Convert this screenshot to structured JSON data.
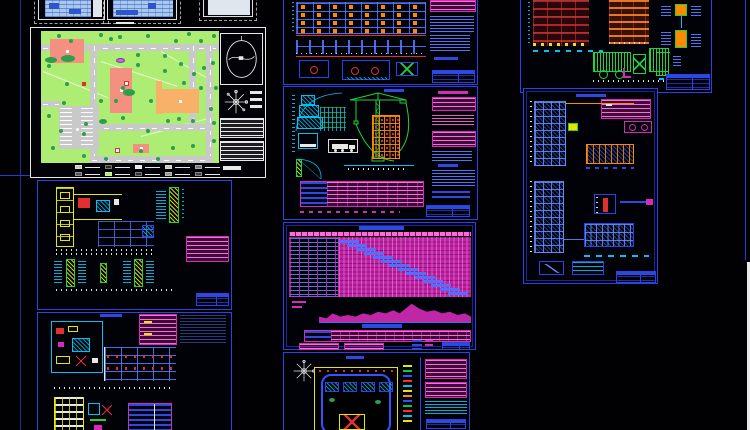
{
  "canvas": {
    "width": 750,
    "height": 430,
    "background": "#010104"
  },
  "colors": {
    "border_blue": "#2744e8",
    "border_blue_dim": "#17279a",
    "white": "#e8e8e8",
    "cyan": "#00c2f2",
    "txt_blue": "#3a6cff",
    "bar_blue": "#2d49e0",
    "mag": "#d42bb8",
    "pink": "#ff6ad9",
    "gantt_bg": "#bf23a6",
    "red": "#e03030",
    "orange": "#ff8a00",
    "green": "#1ed43a",
    "yellow": "#e6e600",
    "site_green": "#aeed74",
    "road_gray": "#c9c9c9",
    "tree_green": "#2c9e4e",
    "bldg_pink": "#f4907f",
    "bldg_orange": "#f8b168",
    "lightblue": "#a9c9ea",
    "purple": "#c06ae0"
  },
  "site_plan": {
    "roads": [
      {
        "x": 0,
        "y": 13,
        "w": 178,
        "h": 7
      },
      {
        "x": 49,
        "y": 13,
        "w": 7,
        "h": 119
      },
      {
        "x": 148,
        "y": 13,
        "w": 7,
        "h": 85
      },
      {
        "x": 165,
        "y": 13,
        "w": 7,
        "h": 119
      },
      {
        "x": 49,
        "y": 93,
        "w": 123,
        "h": 7
      },
      {
        "x": 49,
        "y": 125,
        "w": 123,
        "h": 7
      },
      {
        "x": 0,
        "y": 70,
        "w": 20,
        "h": 6
      }
    ],
    "parking": {
      "x": 18,
      "y": 75,
      "w": 40,
      "h": 43
    },
    "buildings": [
      {
        "x": 9,
        "y": 8,
        "w": 34,
        "h": 24,
        "c": "pink",
        "dot": true
      },
      {
        "x": 69,
        "y": 37,
        "w": 22,
        "h": 45,
        "c": "pink",
        "dot": true
      },
      {
        "x": 115,
        "y": 50,
        "w": 6,
        "h": 33,
        "c": "orange"
      },
      {
        "x": 121,
        "y": 58,
        "w": 37,
        "h": 24,
        "c": "orange",
        "dot": true
      },
      {
        "x": 92,
        "y": 113,
        "w": 16,
        "h": 9,
        "c": "pink",
        "dot": true
      },
      {
        "x": 83,
        "y": 50,
        "w": 5,
        "h": 5,
        "c": "red",
        "dot": true
      },
      {
        "x": 74,
        "y": 117,
        "w": 5,
        "h": 5,
        "c": "red",
        "dot": true
      },
      {
        "x": 41,
        "y": 51,
        "w": 4,
        "h": 4,
        "c": "red"
      }
    ],
    "trees": [
      [
        18,
        5
      ],
      [
        60,
        4
      ],
      [
        79,
        6
      ],
      [
        107,
        5
      ],
      [
        148,
        3
      ],
      [
        173,
        5
      ],
      [
        30,
        10
      ],
      [
        70,
        8
      ],
      [
        135,
        10
      ],
      [
        160,
        10
      ],
      [
        8,
        35
      ],
      [
        26,
        53
      ],
      [
        8,
        85
      ],
      [
        23,
        72
      ],
      [
        43,
        103
      ],
      [
        45,
        93
      ],
      [
        12,
        117
      ],
      [
        43,
        125
      ],
      [
        65,
        128
      ],
      [
        82,
        87
      ],
      [
        107,
        100
      ],
      [
        82,
        57
      ],
      [
        97,
        24
      ],
      [
        97,
        34
      ],
      [
        124,
        25
      ],
      [
        140,
        33
      ],
      [
        124,
        40
      ],
      [
        143,
        52
      ],
      [
        153,
        43
      ],
      [
        163,
        37
      ],
      [
        172,
        32
      ],
      [
        127,
        90
      ],
      [
        138,
        88
      ],
      [
        152,
        90
      ],
      [
        170,
        78
      ],
      [
        173,
        92
      ],
      [
        117,
        128
      ],
      [
        132,
        117
      ],
      [
        152,
        115
      ],
      [
        173,
        110
      ],
      [
        160,
        57
      ],
      [
        175,
        57
      ],
      [
        110,
        70
      ],
      [
        60,
        70
      ],
      [
        75,
        70
      ],
      [
        100,
        120
      ],
      [
        20,
        100
      ]
    ],
    "shrubs": [
      [
        4,
        26,
        12,
        6
      ],
      [
        20,
        24,
        14,
        7
      ],
      [
        82,
        58,
        12,
        7
      ],
      [
        58,
        88,
        8,
        5
      ]
    ],
    "pond": [
      75,
      27,
      9,
      5
    ],
    "legend": {
      "rows": [
        [
          "#c9c9c9",
          "#2a2a2a",
          "#e8e8e8",
          "#c9c9c9",
          "#777777"
        ],
        [
          "#555555",
          "#aeed74",
          "#333333",
          "#999999",
          "#444444"
        ]
      ]
    }
  },
  "sheet_a": {
    "grid": {
      "rows": 4,
      "cols": 8
    }
  },
  "crane_building": {
    "floors": 6,
    "bays": 5
  },
  "gantt": {
    "bars": {
      "count": 14,
      "dx": 8.4,
      "dy": 4.0,
      "w": 20,
      "h": 2.6,
      "color": "#4f6fff"
    },
    "histogram": {
      "points": [
        [
          0,
          4
        ],
        [
          5,
          3
        ],
        [
          9,
          6
        ],
        [
          14,
          4
        ],
        [
          19,
          5
        ],
        [
          24,
          4
        ],
        [
          29,
          6
        ],
        [
          34,
          5
        ],
        [
          39,
          7
        ],
        [
          44,
          6
        ],
        [
          49,
          8
        ],
        [
          53,
          6
        ],
        [
          57,
          9
        ],
        [
          61,
          12
        ],
        [
          66,
          9
        ],
        [
          71,
          7
        ],
        [
          76,
          8
        ],
        [
          81,
          6
        ],
        [
          86,
          7
        ],
        [
          91,
          5
        ],
        [
          96,
          6
        ],
        [
          100,
          4
        ]
      ]
    }
  },
  "sheet_d": {
    "legend_colors": [
      "#e6e600",
      "#00cc44",
      "#2e55ff",
      "#ff3020",
      "#00c2f2",
      "#e6e600",
      "#ff8a00",
      "#2e55ff",
      "#00cc44",
      "#ff3020",
      "#00c2f2",
      "#e6e600"
    ]
  }
}
